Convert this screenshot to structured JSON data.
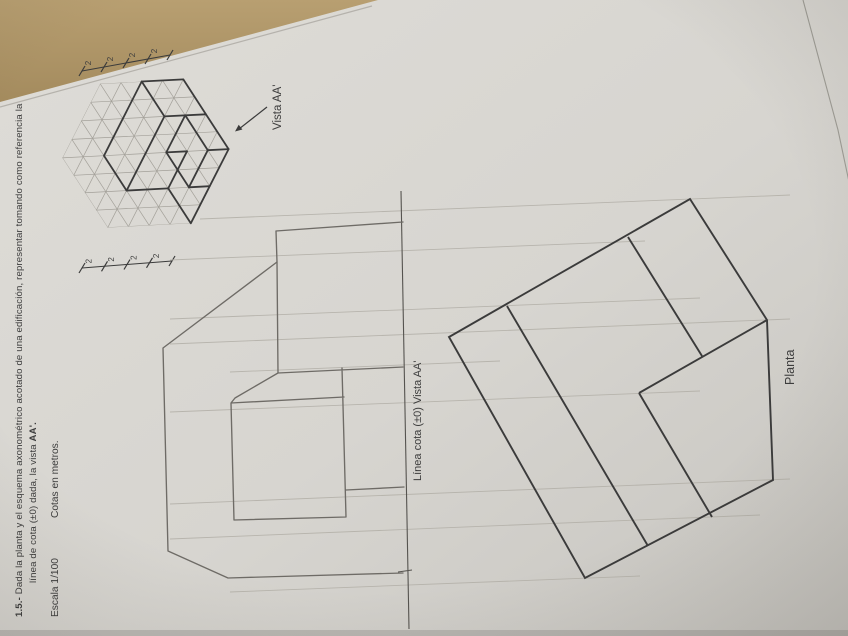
{
  "document": {
    "exercise_number": "1.5.-",
    "title_rest": " Dada la planta y el esquema axonométrico acotado de una edificación, representar tomando como referencia la",
    "title_line2_start": "línea de cota (±0) dada, la vista ",
    "title_line2_bold": "AA'.",
    "scale_label": "Escala 1/100",
    "units_label": "Cotas en metros."
  },
  "axonometric": {
    "view_label": "Vista AA'",
    "dim_labels_top": [
      "2",
      "2",
      "2",
      "2"
    ],
    "dim_labels_bottom": [
      "2",
      "2",
      "2",
      "2"
    ],
    "grid": {
      "cell_meters": 2,
      "hexagon_side_cells": 4
    }
  },
  "plan": {
    "label": "Planta"
  },
  "elevation": {
    "datum_label": "Línea cota (±0) Vista AA'"
  },
  "colors": {
    "desk": "#ab9160",
    "paper": "#d9d7d2",
    "paper_shadow": "#c7c5c0",
    "ink": "#3b3b3b",
    "grid_line": "#a3a099",
    "pencil": "#6e6b66",
    "pencil_light": "#b2afa7"
  }
}
